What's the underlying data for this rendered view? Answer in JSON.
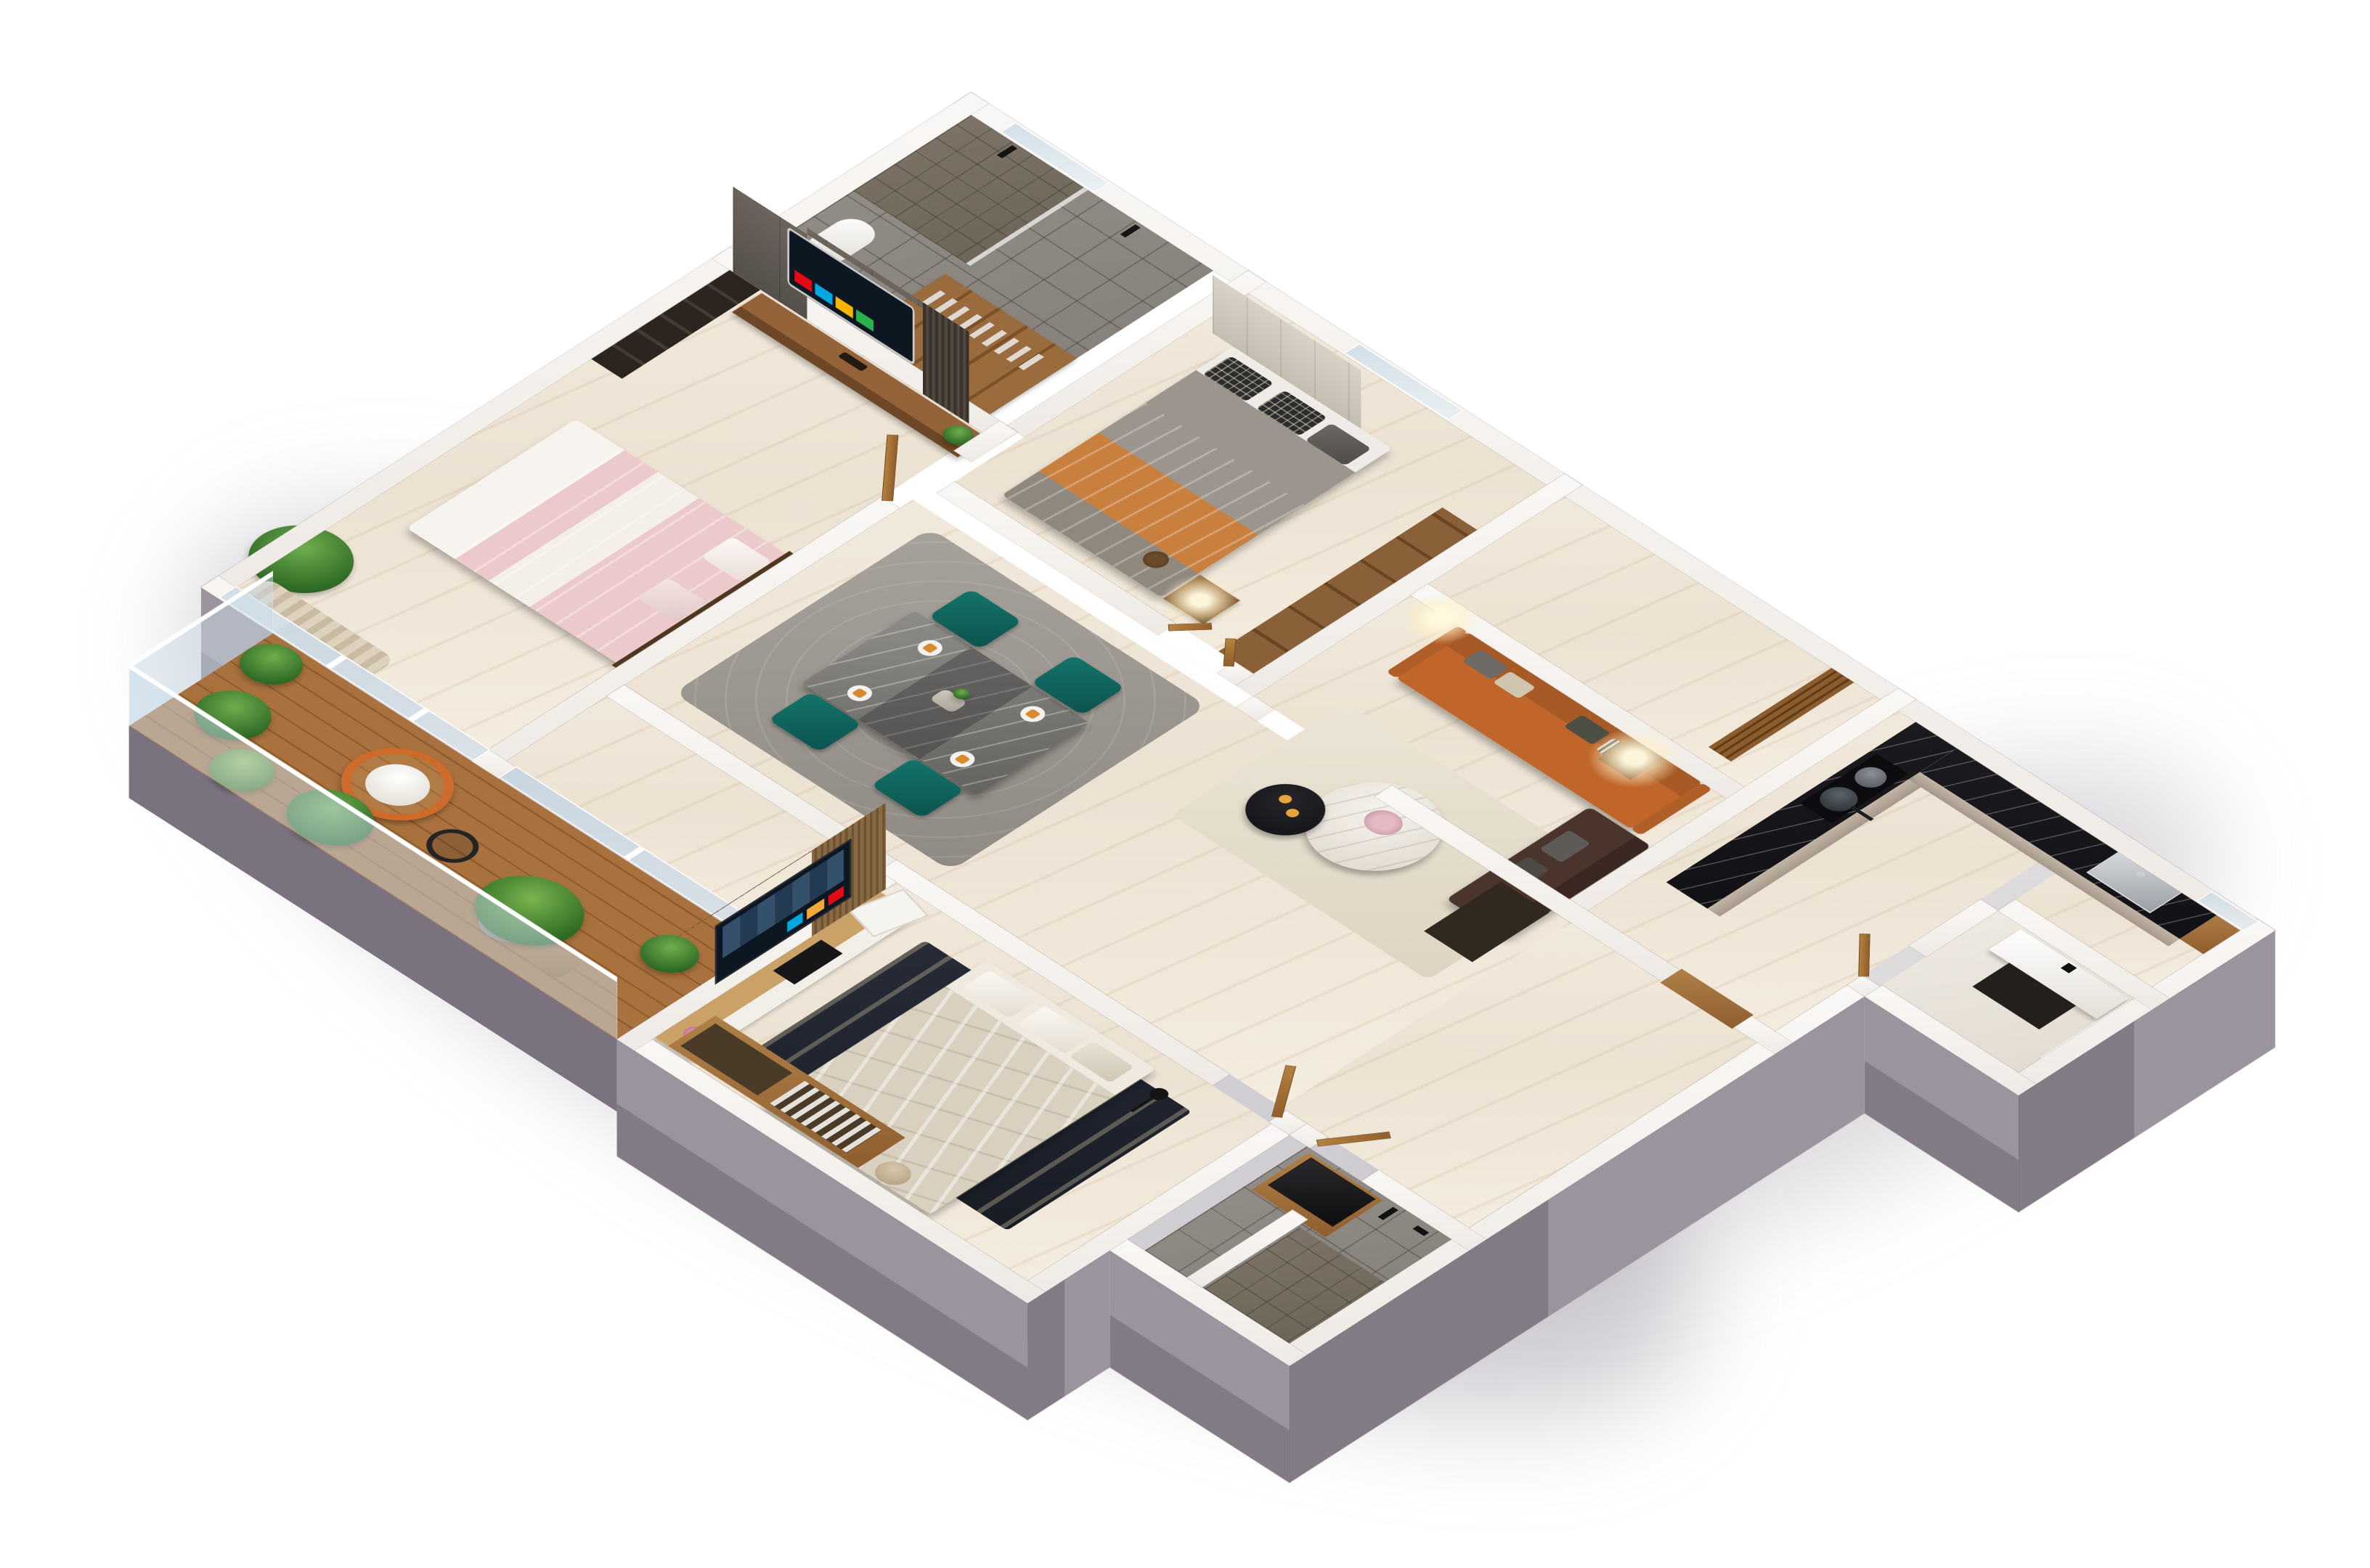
{
  "scene": {
    "type": "3d-floor-plan-render",
    "style": "isometric cutaway apartment visualization on white background",
    "background_color": "#ffffff",
    "exterior_wall_color": "#8d8591",
    "wall_top_color": "#f7f4f1",
    "floor_marble_color": "#efe7d9",
    "description": "Photorealistic 3D isometric floor plan of a furnished apartment with two bedrooms, living-dining area, kitchen, two bathrooms, powder room and a plant-filled balcony"
  },
  "palette": {
    "sofa_orange": "#c0662a",
    "loveseat_brown": "#4a342c",
    "chair_teal": "#0f5f58",
    "bed_pink": "#ecc9cb",
    "bed_beige": "#d9d0c0",
    "counter_black_marble": "#17161a",
    "cabinet_taupe": "#b9ab9c",
    "wood_walnut": "#8a5a33",
    "wood_light": "#c9a36a",
    "deck_wood": "#a06a3a",
    "tile_grey": "#8a8580",
    "accent_glow": "#ffe9b8",
    "plant_green": "#3f7d2f",
    "glass_railing": "#cbdbe7"
  },
  "rooms": [
    {
      "name": "Master Bathroom",
      "floor": "grey tile",
      "furniture": [
        "walk-in shower",
        "black shower fixtures",
        "toilet",
        "towel wardrobe"
      ]
    },
    {
      "name": "Dressing Area",
      "floor": "grey tile",
      "furniture": [
        "open wardrobe with clothes",
        "shelving"
      ]
    },
    {
      "name": "Master Bedroom",
      "floor": "cream marble",
      "furniture": [
        "double bed with pink bedding",
        "curved smart TV on stone feature wall",
        "walnut media console",
        "bonsai plant",
        "dark bookshelf",
        "floor plant",
        "curtain",
        "glass wall to balcony"
      ]
    },
    {
      "name": "Bedroom",
      "floor": "cream marble",
      "furniture": [
        "double bed with grey blanket and orange throw",
        "plaid pillows",
        "padded headboard wall",
        "nightstand with lit lamp",
        "open wardrobe shelves",
        "window"
      ]
    },
    {
      "name": "Entry Hall",
      "floor": "cream marble",
      "furniture": [
        "entry door",
        "wood slat screen"
      ]
    },
    {
      "name": "Living Room",
      "floor": "cream marble",
      "furniture": [
        "orange three-seat sofa",
        "dark brown loveseat",
        "white marble round coffee table",
        "black round side table",
        "lit table lamps",
        "cream rug",
        "dark sideboard"
      ]
    },
    {
      "name": "Dining Area",
      "floor": "cream marble",
      "furniture": [
        "grey marble dining table",
        "four teal armchairs",
        "place settings with orange napkins",
        "grey rug"
      ]
    },
    {
      "name": "Kitchen",
      "floor": "cream marble",
      "furniture": [
        "black marble L-counter",
        "cooktop with pot and pan",
        "taupe cabinets",
        "stainless sink",
        "wood trim passage"
      ]
    },
    {
      "name": "Powder Room",
      "floor": "light marble",
      "furniture": [
        "white basin",
        "black wall faucet",
        "dark vanity",
        "window"
      ]
    },
    {
      "name": "Hallway",
      "floor": "cream marble",
      "furniture": [
        "wooden doors"
      ]
    },
    {
      "name": "Second Bathroom",
      "floor": "grey tile",
      "furniture": [
        "black vessel sink on wood vanity",
        "black shower set",
        "stone shower floor",
        "white partition",
        "wooden door"
      ]
    },
    {
      "name": "Second Bedroom",
      "floor": "cream marble",
      "furniture": [
        "double bed with beige duvet",
        "dark patterned rug",
        "smart TV on wood slat wall",
        "light wood TV console",
        "media boxes",
        "flower vase",
        "open wardrobe with hanging shirts",
        "towel basket",
        "leaning picture frame",
        "black reading lamp"
      ]
    },
    {
      "name": "Balcony",
      "floor": "wood deck",
      "furniture": [
        "glass railing with white handrail",
        "orange egg chair with white cushion",
        "wire side table",
        "potted plants",
        "banana plant",
        "wood stool"
      ]
    }
  ],
  "tvs": [
    {
      "location": "Master Bedroom",
      "content": "streaming app grid with movie thumbnails"
    },
    {
      "location": "Second Bedroom",
      "content": "streaming app grid with movie thumbnails"
    }
  ],
  "app_tile_colors": [
    "#e50914",
    "#00a8e1",
    "#f7b500",
    "#2bb24c",
    "#1a73ba",
    "#8e44ad"
  ]
}
